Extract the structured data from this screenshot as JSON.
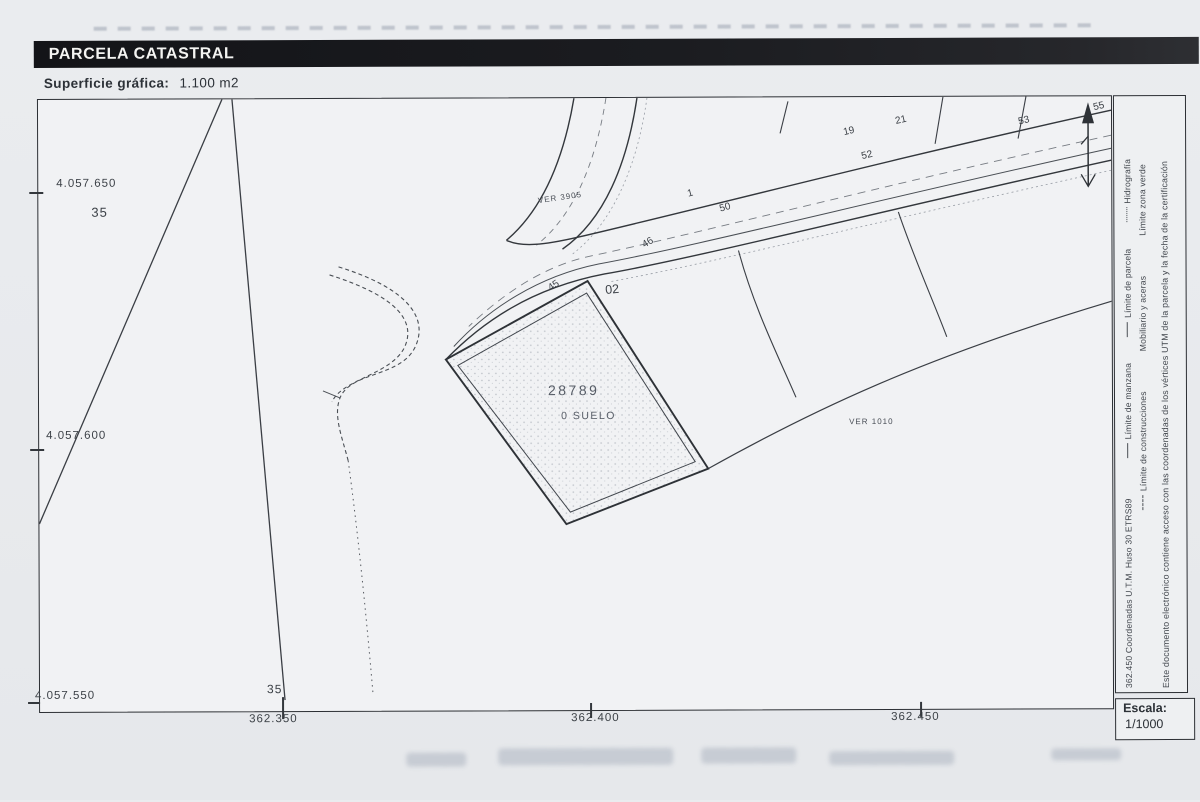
{
  "document": {
    "section_title": "PARCELA CATASTRAL",
    "surface_label": "Superficie gráfica:",
    "surface_value": "1.100 m2"
  },
  "map": {
    "parcel_number": "28789",
    "parcel_use": "0 SUELO",
    "ver_top": "VER 3905",
    "ver_right": "VER 1010",
    "numbers": {
      "n19": "19",
      "n21": "21",
      "n52": "52",
      "n53": "53",
      "n55": "55",
      "n50": "50",
      "n1": "1",
      "n45": "45",
      "n46": "46",
      "n02": "02"
    },
    "axis": {
      "y": [
        "4.057.650",
        "4.057.600",
        "4.057.550"
      ],
      "x": [
        "362.350",
        "362.400",
        "362.450"
      ],
      "block_left": "35",
      "block_bottom": "35"
    }
  },
  "sidebar": {
    "coords_note": "362.450 Coordenadas U.T.M. Huso 30 ETRS89",
    "legend": {
      "manzana": "Límite de manzana",
      "construcciones": "Límite de construcciones",
      "parcela": "Límite de parcela",
      "mobiliario": "Mobiliario y aceras",
      "hidrografia": "Hidrografía",
      "zona_verde": "Límite zona verde"
    },
    "cert_note": "Este documento electrónico contiene acceso con las coordenadas de los vértices UTM de la parcela y la fecha de la certificación"
  },
  "scale": {
    "label": "Escala:",
    "value": "1/1000"
  }
}
